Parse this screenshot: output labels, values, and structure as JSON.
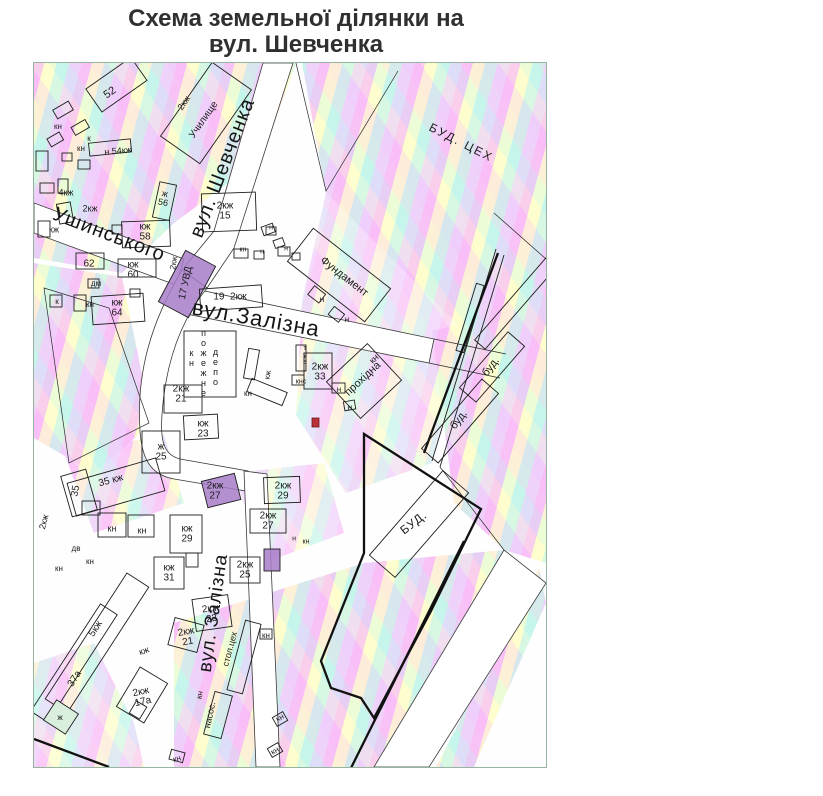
{
  "title": {
    "line1": "Схема земельної ділянки на",
    "line2": "вул. Шевченка"
  },
  "map": {
    "colors": {
      "purple": "#a87cc9",
      "marker_red": "#b8303a",
      "border": "#96b4a0",
      "ink": "#1c1c1c"
    },
    "marker": {
      "note": "red plot marker rectangle"
    },
    "labels": [
      {
        "t": "вул. Шевченка",
        "x": 189,
        "y": 105,
        "r": -69,
        "fs": 20,
        "cls": "street",
        "name": "street-label-shevchenka"
      },
      {
        "t": "Ушинського",
        "x": 75,
        "y": 172,
        "r": 21,
        "fs": 20,
        "cls": "street",
        "name": "street-label-ushynskoho"
      },
      {
        "t": "вул.Залізна",
        "x": 222,
        "y": 256,
        "r": 10,
        "fs": 22,
        "cls": "street",
        "name": "street-label-zalizna-h"
      },
      {
        "t": "вул. Залізна",
        "x": 180,
        "y": 550,
        "r": -82,
        "fs": 19,
        "cls": "street",
        "name": "street-label-zalizna-v"
      },
      {
        "t": "БУД. ЦЕХ",
        "x": 427,
        "y": 80,
        "r": 27,
        "fs": 12,
        "ls": 2,
        "name": "area-label-bud-tseh"
      },
      {
        "t": "2кж",
        "x": 150,
        "y": 40,
        "r": -55,
        "fs": 9,
        "name": "bld-label"
      },
      {
        "t": "Училище",
        "x": 170,
        "y": 57,
        "r": -55,
        "fs": 10,
        "name": "area-label-uchylyshche"
      },
      {
        "t": "Фундамент",
        "x": 310,
        "y": 214,
        "r": 38,
        "fs": 11,
        "name": "area-label-fundament"
      },
      {
        "t": "кн",
        "x": 340,
        "y": 296,
        "r": -43,
        "fs": 9,
        "name": "bld-label"
      },
      {
        "t": "прохідна",
        "x": 329,
        "y": 316,
        "r": -43,
        "fs": 11,
        "name": "area-label-prohidna"
      },
      {
        "t": "кн",
        "x": 157,
        "y": 295,
        "fs": 9,
        "cls": "vup",
        "name": "area-label-depot-kn"
      },
      {
        "t": "пожежне",
        "x": 169,
        "y": 300,
        "fs": 9,
        "cls": "vup",
        "name": "area-label-depot-1"
      },
      {
        "t": "депо",
        "x": 181,
        "y": 304,
        "fs": 9,
        "cls": "vup",
        "name": "area-label-depot-2"
      },
      {
        "t": "БУД.",
        "x": 380,
        "y": 460,
        "r": -38,
        "fs": 12,
        "ls": 1,
        "name": "area-label-bud"
      },
      {
        "t": "буд.",
        "x": 457,
        "y": 304,
        "r": -52,
        "fs": 11,
        "name": "area-label-bud-1"
      },
      {
        "t": "буд.",
        "x": 425,
        "y": 357,
        "r": -52,
        "fs": 11,
        "name": "area-label-bud-2"
      },
      {
        "t": "стол.цех",
        "x": 196,
        "y": 586,
        "r": -75,
        "fs": 9,
        "name": "area-label-stol-tseh"
      },
      {
        "t": "насос.",
        "x": 176,
        "y": 652,
        "r": -78,
        "fs": 9,
        "name": "area-label-nasos"
      },
      {
        "t": "кн",
        "x": 166,
        "y": 632,
        "r": -78,
        "fs": 8,
        "name": "bld-label"
      },
      {
        "t": "52",
        "x": 76,
        "y": 30,
        "r": -35,
        "fs": 11,
        "name": "bld-label-52"
      },
      {
        "t": "кн",
        "x": 24,
        "y": 64,
        "fs": 8,
        "name": "bld-label"
      },
      {
        "t": "к",
        "x": 55,
        "y": 76,
        "fs": 8,
        "name": "bld-label"
      },
      {
        "t": "кн",
        "x": 47,
        "y": 86,
        "fs": 8,
        "name": "bld-label"
      },
      {
        "t": "н 54кж",
        "x": 84,
        "y": 88,
        "r": -5,
        "fs": 9,
        "name": "bld-label-54"
      },
      {
        "t": "4кж",
        "x": 32,
        "y": 130,
        "fs": 9,
        "name": "bld-label"
      },
      {
        "t": "2кж",
        "x": 56,
        "y": 146,
        "fs": 9,
        "name": "bld-label"
      },
      {
        "t": "кж",
        "x": 20,
        "y": 167,
        "fs": 9,
        "name": "bld-label"
      },
      {
        "t": "ж\n56",
        "x": 130,
        "y": 135,
        "r": 12,
        "fs": 9,
        "name": "bld-label-56"
      },
      {
        "t": "2кж\n15",
        "x": 191,
        "y": 148,
        "fs": 10,
        "name": "bld-label-15"
      },
      {
        "t": "кж\n58",
        "x": 111,
        "y": 169,
        "fs": 10,
        "name": "bld-label-58"
      },
      {
        "t": "62",
        "x": 55,
        "y": 201,
        "fs": 10,
        "name": "bld-label-62"
      },
      {
        "t": "кж\n60",
        "x": 99,
        "y": 207,
        "fs": 10,
        "name": "bld-label-60"
      },
      {
        "t": "дм",
        "x": 62,
        "y": 221,
        "fs": 8,
        "name": "bld-label"
      },
      {
        "t": "кн",
        "x": 56,
        "y": 242,
        "fs": 8,
        "name": "bld-label"
      },
      {
        "t": "кж\n64",
        "x": 83,
        "y": 245,
        "fs": 10,
        "name": "bld-label-64"
      },
      {
        "t": "к",
        "x": 23,
        "y": 239,
        "fs": 8,
        "name": "bld-label"
      },
      {
        "t": "2кж",
        "x": 140,
        "y": 200,
        "r": -80,
        "fs": 8,
        "name": "bld-label"
      },
      {
        "t": "17 УВД",
        "x": 152,
        "y": 220,
        "r": -78,
        "fs": 10,
        "name": "bld-label-uvd"
      },
      {
        "t": "19  2кж",
        "x": 196,
        "y": 234,
        "fs": 10,
        "name": "bld-label-19"
      },
      {
        "t": "кн",
        "x": 209,
        "y": 188,
        "fs": 7,
        "name": "bld-label"
      },
      {
        "t": "н",
        "x": 228,
        "y": 190,
        "fs": 7,
        "name": "bld-label"
      },
      {
        "t": "н",
        "x": 252,
        "y": 187,
        "fs": 7,
        "name": "bld-label"
      },
      {
        "t": "н",
        "x": 237,
        "y": 166,
        "fs": 7,
        "name": "bld-label"
      },
      {
        "t": "2кж\n21",
        "x": 147,
        "y": 331,
        "fs": 10,
        "name": "bld-label-21"
      },
      {
        "t": "кн",
        "x": 214,
        "y": 331,
        "fs": 8,
        "name": "bld-label"
      },
      {
        "t": "кж",
        "x": 234,
        "y": 312,
        "r": -80,
        "fs": 8,
        "name": "bld-label"
      },
      {
        "t": "кж\n23",
        "x": 169,
        "y": 366,
        "fs": 10,
        "name": "bld-label-23"
      },
      {
        "t": "ж\n25",
        "x": 127,
        "y": 389,
        "fs": 10,
        "name": "bld-label-25"
      },
      {
        "t": "35",
        "x": 42,
        "y": 428,
        "r": -80,
        "fs": 10,
        "name": "bld-label-35"
      },
      {
        "t": "35 кж",
        "x": 77,
        "y": 418,
        "r": -15,
        "fs": 10,
        "name": "bld-label-35kzh"
      },
      {
        "t": "2кж\n27",
        "x": 181,
        "y": 428,
        "fs": 10,
        "name": "bld-label-27"
      },
      {
        "t": "2кж\n29",
        "x": 249,
        "y": 428,
        "fs": 10,
        "name": "bld-label-29"
      },
      {
        "t": "2кж\n27",
        "x": 234,
        "y": 458,
        "fs": 10,
        "name": "bld-label-27b"
      },
      {
        "t": "кж\n29",
        "x": 153,
        "y": 471,
        "fs": 10,
        "name": "bld-label-29b"
      },
      {
        "t": "кж\n31",
        "x": 135,
        "y": 510,
        "fs": 10,
        "name": "bld-label-31"
      },
      {
        "t": "2кж\n25",
        "x": 211,
        "y": 507,
        "fs": 10,
        "name": "bld-label-25b"
      },
      {
        "t": "2кж\n23",
        "x": 177,
        "y": 551,
        "r": -8,
        "fs": 10,
        "name": "bld-label-23b"
      },
      {
        "t": "н",
        "x": 260,
        "y": 477,
        "fs": 7,
        "name": "bld-label"
      },
      {
        "t": "кн",
        "x": 272,
        "y": 480,
        "fs": 7,
        "name": "bld-label"
      },
      {
        "t": "дв",
        "x": 42,
        "y": 486,
        "fs": 8,
        "name": "bld-label"
      },
      {
        "t": "кн",
        "x": 25,
        "y": 506,
        "fs": 8,
        "name": "bld-label"
      },
      {
        "t": "кн",
        "x": 56,
        "y": 499,
        "fs": 8,
        "name": "bld-label"
      },
      {
        "t": "кн",
        "x": 78,
        "y": 466,
        "fs": 9,
        "name": "bld-label"
      },
      {
        "t": "кн",
        "x": 108,
        "y": 468,
        "fs": 9,
        "name": "bld-label"
      },
      {
        "t": "2кж",
        "x": 10,
        "y": 459,
        "r": -75,
        "fs": 9,
        "name": "bld-label"
      },
      {
        "t": "5кж",
        "x": 62,
        "y": 566,
        "r": -57,
        "fs": 10,
        "name": "bld-label-5kzh"
      },
      {
        "t": "37а",
        "x": 41,
        "y": 616,
        "r": -57,
        "fs": 10,
        "name": "bld-label-37a"
      },
      {
        "t": "кж",
        "x": 110,
        "y": 588,
        "r": -20,
        "fs": 9,
        "name": "bld-label"
      },
      {
        "t": "2кж\n21",
        "x": 153,
        "y": 574,
        "r": -10,
        "fs": 10,
        "name": "bld-label-21b"
      },
      {
        "t": "2кж\n17а",
        "x": 108,
        "y": 634,
        "r": -12,
        "fs": 10,
        "name": "bld-label-17a"
      },
      {
        "t": "ж",
        "x": 26,
        "y": 655,
        "fs": 8,
        "name": "bld-label"
      },
      {
        "t": "кн",
        "x": 232,
        "y": 573,
        "fs": 8,
        "name": "bld-label"
      },
      {
        "t": "кн",
        "x": 246,
        "y": 655,
        "r": -30,
        "fs": 8,
        "name": "bld-label"
      },
      {
        "t": "кн",
        "x": 241,
        "y": 688,
        "r": -30,
        "fs": 8,
        "name": "bld-label"
      },
      {
        "t": "кн",
        "x": 143,
        "y": 696,
        "r": -15,
        "fs": 8,
        "name": "bld-label"
      },
      {
        "t": "2кж\n33",
        "x": 286,
        "y": 309,
        "fs": 10,
        "name": "bld-label-33"
      },
      {
        "t": "тув.",
        "x": 271,
        "y": 296,
        "fs": 7,
        "cls": "vup",
        "name": "bld-label-tuv"
      },
      {
        "t": "кнс",
        "x": 267,
        "y": 320,
        "fs": 7,
        "name": "bld-label"
      },
      {
        "t": "н",
        "x": 288,
        "y": 237,
        "fs": 8,
        "name": "bld-label"
      },
      {
        "t": "н",
        "x": 313,
        "y": 257,
        "fs": 8,
        "name": "bld-label"
      },
      {
        "t": "н",
        "x": 305,
        "y": 327,
        "fs": 8,
        "name": "bld-label"
      },
      {
        "t": "н",
        "x": 316,
        "y": 345,
        "fs": 8,
        "name": "bld-label"
      }
    ]
  }
}
